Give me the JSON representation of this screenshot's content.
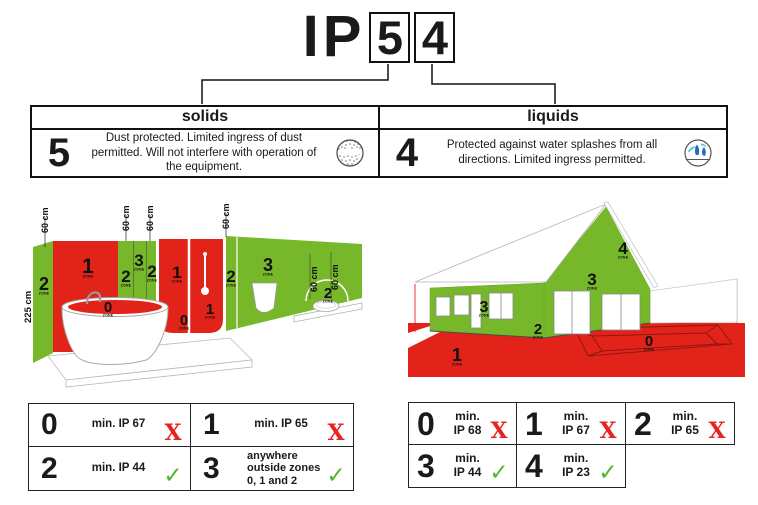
{
  "title": {
    "prefix": "IP",
    "digit_boxes": [
      "5",
      "4"
    ]
  },
  "colors": {
    "zone_red": "#e2231a",
    "zone_green": "#76b82a",
    "check_green": "#54b426",
    "cross_red": "#e5231f",
    "water_light": "#5bc2e7",
    "water_dark": "#1d71b8",
    "line_black": "#1a1a1a"
  },
  "spec_table": {
    "solids": {
      "header": "solids",
      "rating": "5",
      "description": "Dust protected. Limited ingress of dust permitted. Will not interfere with operation of the equipment.",
      "icon": "dust-circle-icon"
    },
    "liquids": {
      "header": "liquids",
      "rating": "4",
      "description": "Protected against water splashes from all directions. Limited ingress permitted.",
      "icon": "water-splash-icon"
    }
  },
  "bathroom_diagram": {
    "height_label": "225 cm",
    "measure_labels": [
      "60 cm",
      "60 cm",
      "60 cm",
      "60 cm",
      "60 cm",
      "60 cm"
    ],
    "zone_labels": [
      {
        "n": "2",
        "sub": "ZONE"
      },
      {
        "n": "1",
        "sub": "ZONE"
      },
      {
        "n": "2",
        "sub": "ZONE"
      },
      {
        "n": "3",
        "sub": "ZONE"
      },
      {
        "n": "2",
        "sub": "ZONE"
      },
      {
        "n": "1",
        "sub": "ZONE"
      },
      {
        "n": "0",
        "sub": "ZONE"
      },
      {
        "n": "1",
        "sub": "ZONE"
      },
      {
        "n": "2",
        "sub": "ZONE"
      },
      {
        "n": "3",
        "sub": "ZONE"
      },
      {
        "n": "2",
        "sub": "ZONE"
      },
      {
        "n": "0",
        "sub": "ZONE"
      }
    ]
  },
  "house_diagram": {
    "zone_labels": [
      {
        "n": "4",
        "sub": "ZONE"
      },
      {
        "n": "3",
        "sub": "ZONE"
      },
      {
        "n": "3",
        "sub": "ZONE"
      },
      {
        "n": "2",
        "sub": "ZONE"
      },
      {
        "n": "1",
        "sub": "ZONE"
      },
      {
        "n": "0",
        "sub": "ZONE"
      }
    ]
  },
  "bathroom_zone_table": {
    "rows": [
      {
        "zone": "0",
        "requirement": "min. IP 67",
        "allowed": false,
        "mark": "X"
      },
      {
        "zone": "1",
        "requirement": "min. IP 65",
        "allowed": false,
        "mark": "X"
      },
      {
        "zone": "2",
        "requirement": "min. IP 44",
        "allowed": true,
        "mark": "✓"
      },
      {
        "zone": "3",
        "requirement": "anywhere outside zones 0, 1 and 2",
        "allowed": true,
        "mark": "✓"
      }
    ]
  },
  "outdoor_zone_table": {
    "rows": [
      {
        "zone": "0",
        "requirement": "min. IP 68",
        "allowed": false,
        "mark": "X"
      },
      {
        "zone": "1",
        "requirement": "min. IP 67",
        "allowed": false,
        "mark": "X"
      },
      {
        "zone": "2",
        "requirement": "min. IP 65",
        "allowed": false,
        "mark": "X"
      },
      {
        "zone": "3",
        "requirement": "min. IP 44",
        "allowed": true,
        "mark": "✓"
      },
      {
        "zone": "4",
        "requirement": "min. IP 23",
        "allowed": true,
        "mark": "✓"
      }
    ]
  }
}
